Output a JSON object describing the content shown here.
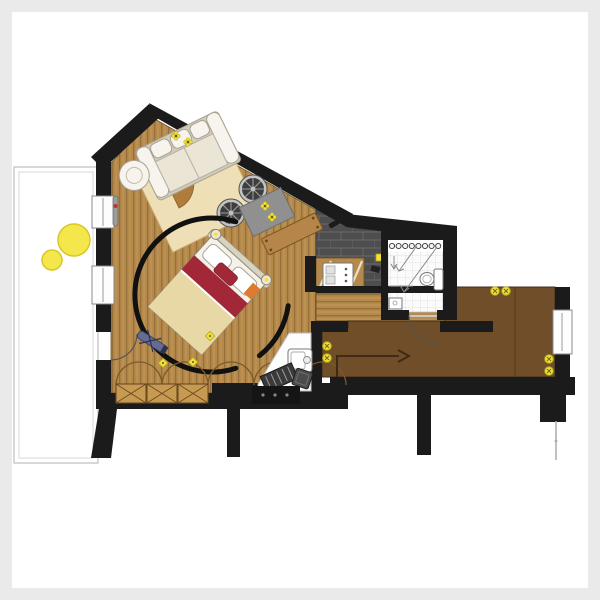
{
  "meta": {
    "label": "apartment floor plan, top-down architectural drawing, no text labels"
  },
  "colors": {
    "bg": "#eaeaea",
    "paper": "#ffffff",
    "wall": "#1b1b1b",
    "wood": "#b5894a",
    "woodLine": "#96703a",
    "woodHi": "#c49a5e",
    "brick": "#4e4e4e",
    "brickLine": "#6a6a6a",
    "tile": "#fbfbfb",
    "tileLine": "#dcdcdc",
    "hall": "#6f4e29",
    "hallSeam": "#523819",
    "rug": "#eedfb6",
    "rugEdge": "#cba76e",
    "wedge": "#b07c3c",
    "sofaBase": "#d2cbb8",
    "sofaCushion": "#f6f4ec",
    "sofaEdge": "#a8a296",
    "bedWhite": "#f4f1e8",
    "bedRed": "#a32837",
    "bedCream": "#e8d8a6",
    "mat": "#909090",
    "matEdge": "#6e6e6e",
    "bench": "#b5854a",
    "benchEdge": "#7a571f",
    "stoolDark": "#3e3e3e",
    "stoolRing": "#c4c4c4",
    "stoolSpoke": "#9b9b9b",
    "yellow": "#f0e23c",
    "yellowEdge": "#b9a712",
    "wardrobe": "#c79a52",
    "wardrobeLine": "#6b4a1f",
    "nook": "#fdfdfd",
    "blue": "#666c91",
    "arrow": "#3f2b15",
    "console": "#151515",
    "plant": "#f3e74b",
    "plantEdge": "#d9c824"
  },
  "rooms": [
    {
      "id": "living-bedroom",
      "floor": "vertical wood planks",
      "shape": "polygon with sloped attic wall"
    },
    {
      "id": "kitchen-zone",
      "floor": "dark brick tile"
    },
    {
      "id": "bathroom",
      "floor": "white grid tile"
    },
    {
      "id": "corridor",
      "floor": "horizontal wood planks"
    },
    {
      "id": "hallway-entry",
      "floor": "plain brown"
    },
    {
      "id": "balcony",
      "floor": "white, double outline"
    }
  ],
  "furniture": [
    {
      "id": "sofa",
      "room": "living-bedroom"
    },
    {
      "id": "armchair",
      "room": "living-bedroom"
    },
    {
      "id": "area-rug",
      "room": "living-bedroom"
    },
    {
      "id": "quarter-round-table",
      "room": "living-bedroom"
    },
    {
      "id": "round-stool",
      "count": 2,
      "room": "living-bedroom"
    },
    {
      "id": "flower-mat",
      "room": "living-bedroom"
    },
    {
      "id": "wooden-bench",
      "room": "living-bedroom"
    },
    {
      "id": "double-bed",
      "room": "living-bedroom",
      "rotation_deg": 42
    },
    {
      "id": "curved-partition",
      "room": "living-bedroom"
    },
    {
      "id": "folding-stool",
      "room": "living-bedroom"
    },
    {
      "id": "wardrobe-3-sections",
      "room": "living-bedroom"
    },
    {
      "id": "desk-nook-washstand",
      "room": "living-bedroom"
    },
    {
      "id": "striped-doormat",
      "room": "living-bedroom"
    },
    {
      "id": "small-stool",
      "room": "living-bedroom"
    },
    {
      "id": "kitchen-counter-cooktop",
      "room": "kitchen-zone"
    },
    {
      "id": "toilet",
      "room": "bathroom"
    },
    {
      "id": "shower-slope-arrows",
      "room": "bathroom"
    },
    {
      "id": "radiator-row",
      "room": "bathroom"
    },
    {
      "id": "wall-radiator",
      "room": "living-bedroom"
    },
    {
      "id": "potted-plant",
      "count": 2,
      "room": "balcony"
    }
  ],
  "symbols": {
    "switch-pairs-yellow": 3,
    "ceiling-diamonds-yellow": 3,
    "flower-marks-yellow": 4,
    "entry-direction-arrow": 1,
    "door-swings": 2,
    "wardrobe-scallop-arcs": 5
  }
}
